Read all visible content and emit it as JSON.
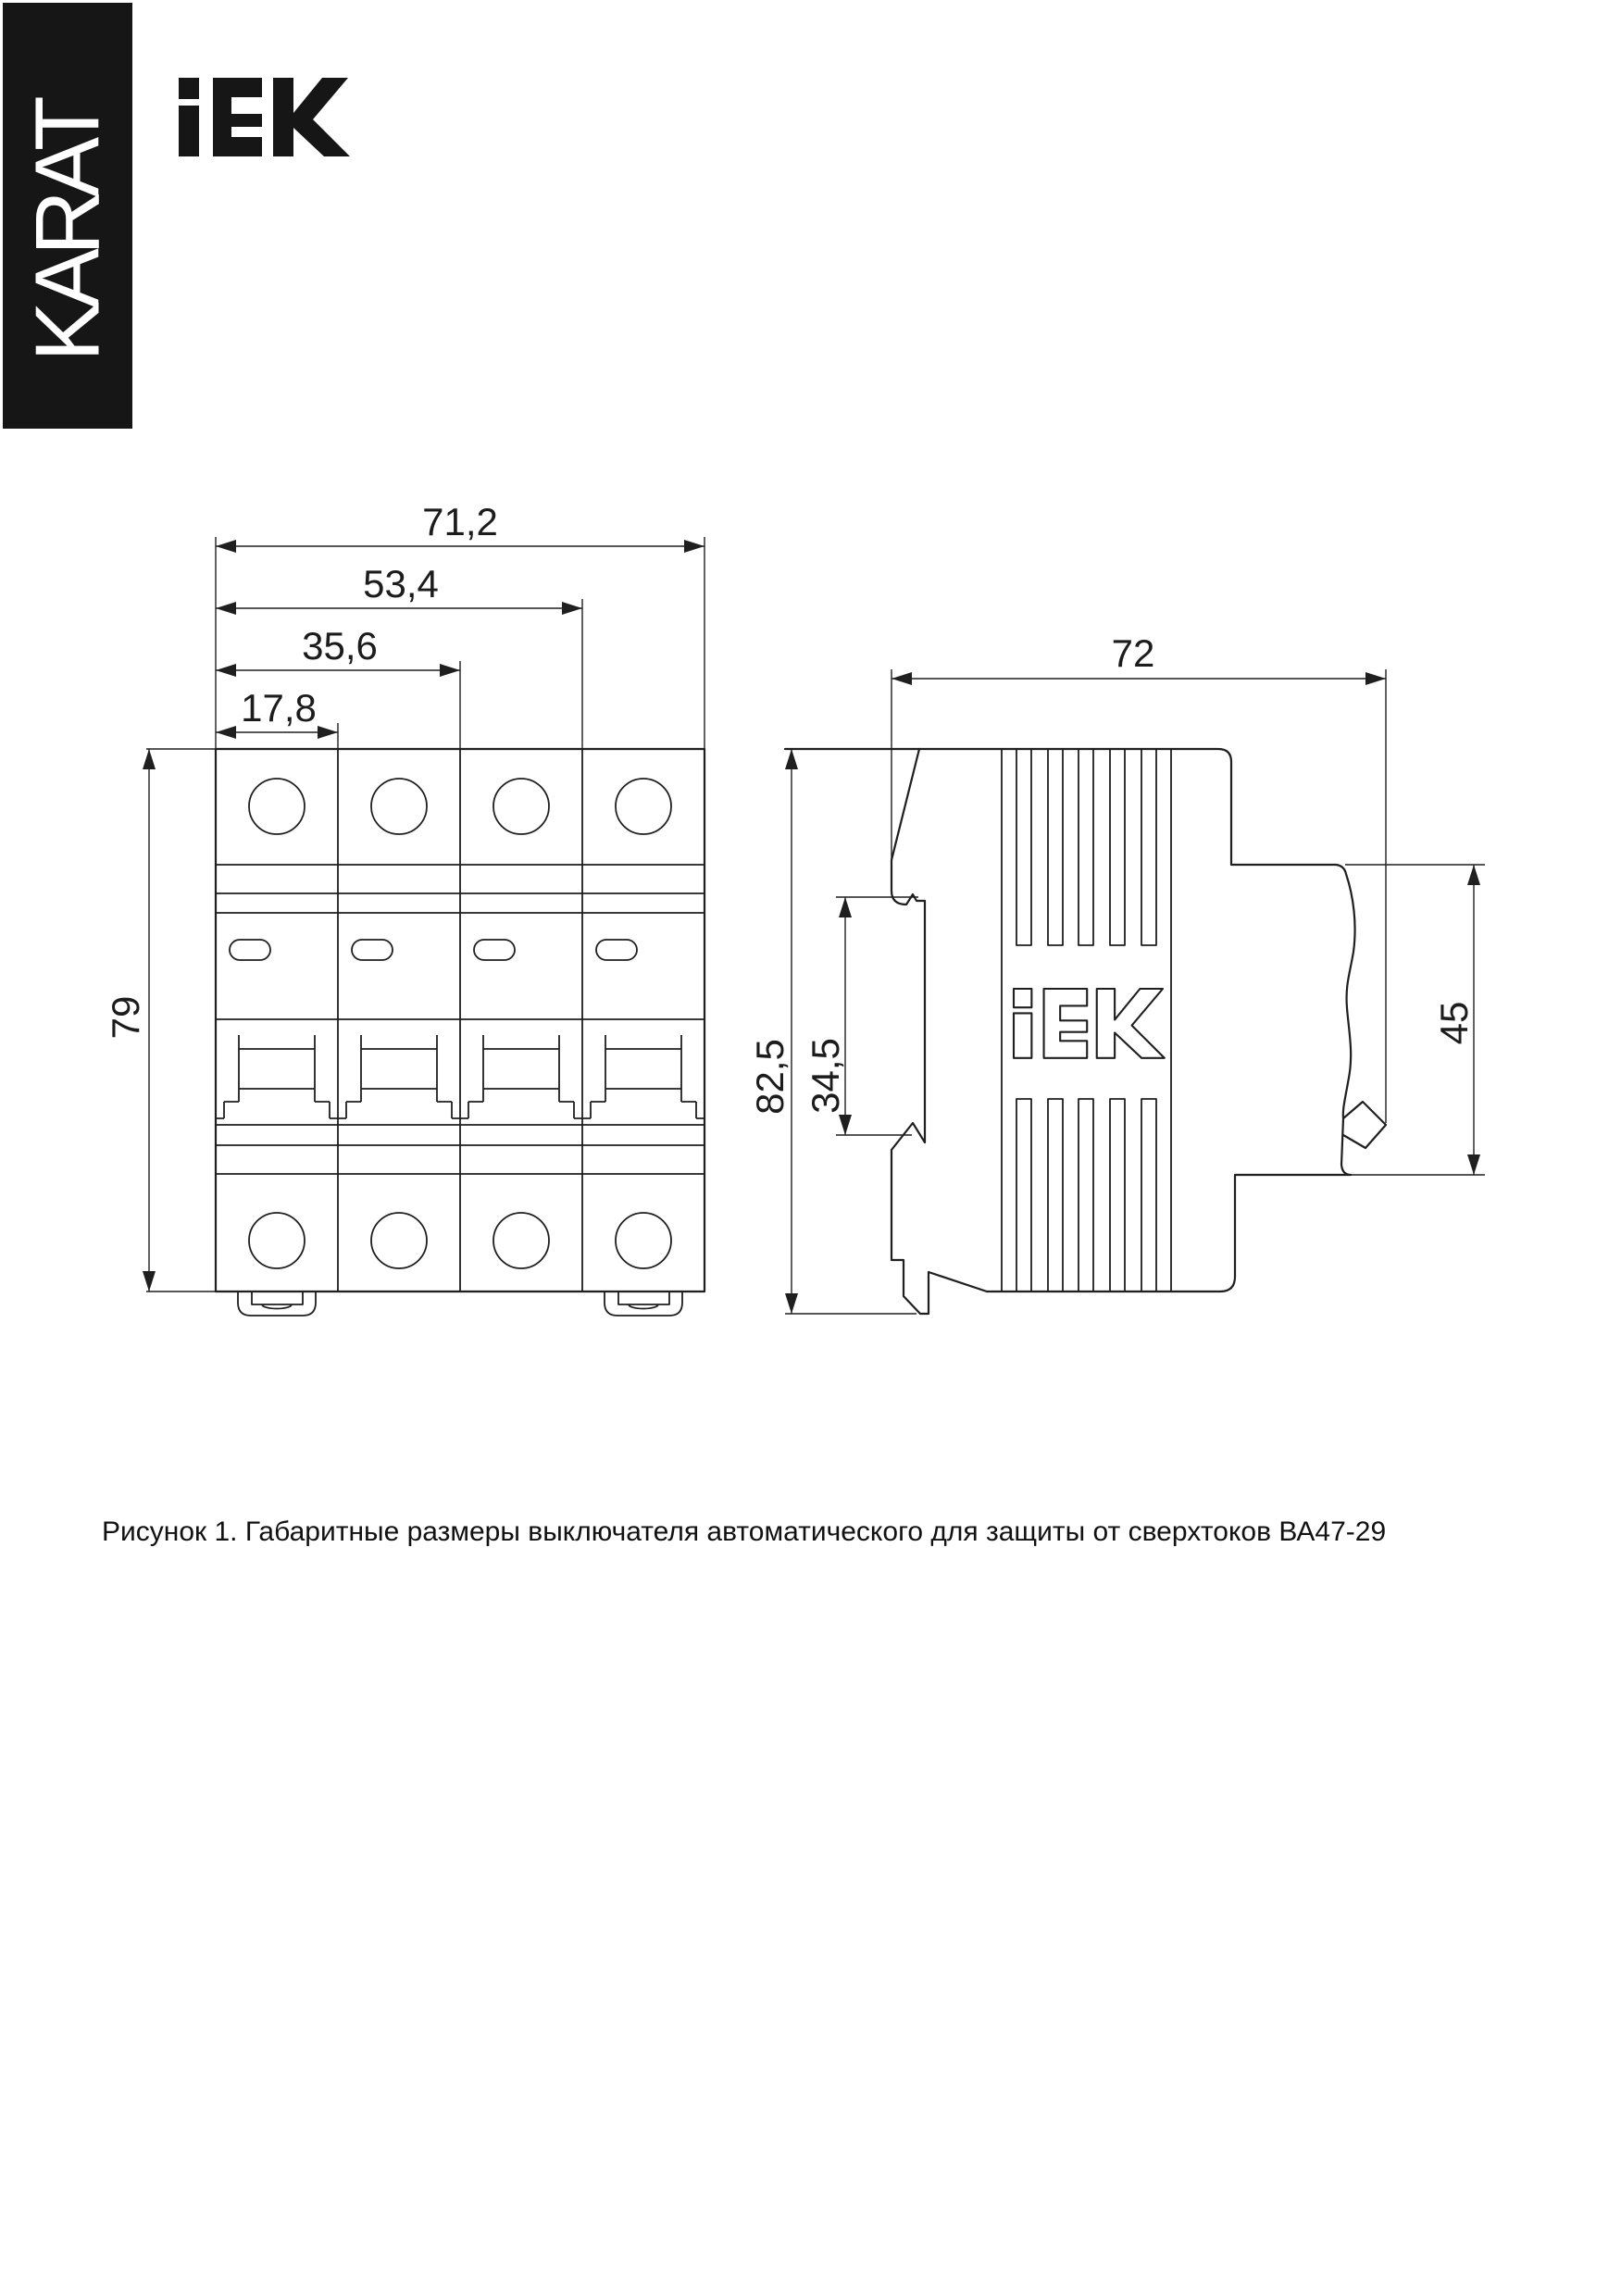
{
  "banner": {
    "text": "KARAT"
  },
  "logo": {
    "name": "IEK"
  },
  "figure": {
    "front_view": {
      "dims": {
        "total_width": "71,2",
        "width_3_poles": "53,4",
        "width_2_poles": "35,6",
        "width_1_pole": "17,8",
        "height": "79"
      }
    },
    "side_view": {
      "dims": {
        "depth": "72",
        "total_height": "82,5",
        "din_rail_height": "34,5",
        "lower_depth": "45"
      }
    }
  },
  "caption": "Рисунок 1. Габаритные размеры выключателя автоматического для защиты от сверхтоков ВА47-29"
}
